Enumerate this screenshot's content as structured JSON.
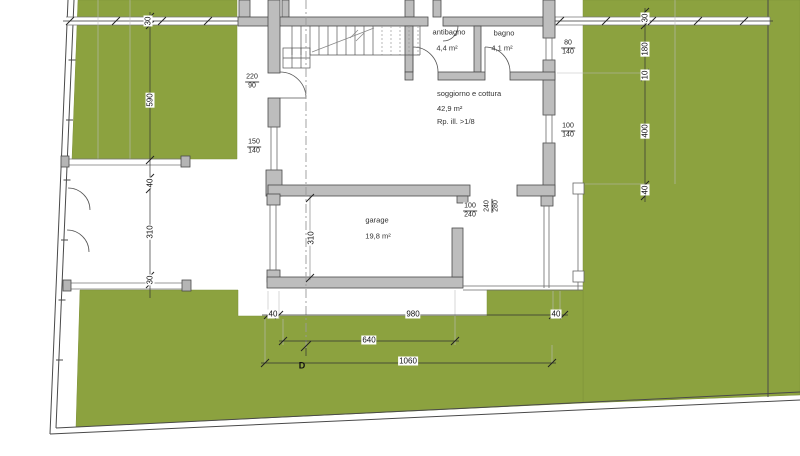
{
  "colors": {
    "garden_green": "#8CA23F",
    "wall_fill": "#BDBDBD",
    "line_dark": "#3A3A3A"
  },
  "rooms": {
    "antibagno": {
      "name": "antibagno",
      "area": "4,4 m²"
    },
    "bagno": {
      "name": "bagno",
      "area": "4,1 m²"
    },
    "soggiorno": {
      "name": "soggiorno e cottura",
      "area": "42,9 m²",
      "note": "Rp. ill. >1/8"
    },
    "garage": {
      "name": "garage",
      "area": "19,8 m²"
    }
  },
  "dimensions": {
    "fence_top": "30",
    "left_590": "590",
    "left_40": "40",
    "left_310": "310",
    "left_30": "30",
    "right_30": "30",
    "right_180": "180",
    "right_10": "10",
    "right_400": "400",
    "right_40": "40",
    "bottom_40_left": "40",
    "bottom_980": "980",
    "bottom_40_right": "40",
    "bottom_640": "640",
    "bottom_1060": "1060",
    "garage_310": "310",
    "section_label": "D"
  },
  "openings": {
    "entrance_door": {
      "w": "220",
      "h": "90"
    },
    "window_left": {
      "w": "150",
      "h": "140"
    },
    "window_bagno": {
      "w": "80",
      "h": "140"
    },
    "window_living": {
      "w": "100",
      "h": "140"
    },
    "garage_door": {
      "w": "100",
      "h": "240"
    },
    "patio_opening": {
      "w": "240",
      "h": "280"
    }
  }
}
